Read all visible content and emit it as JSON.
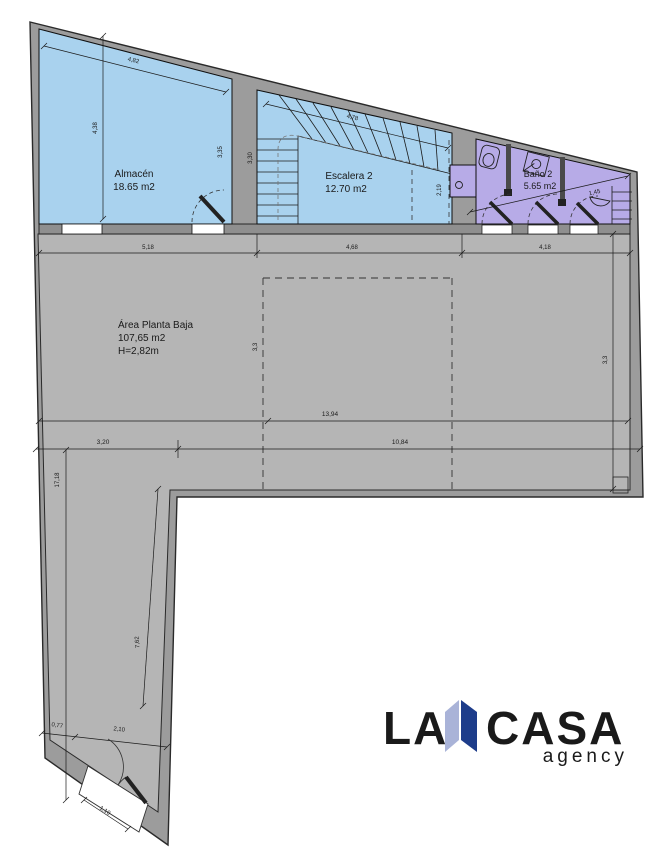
{
  "plan": {
    "rooms": {
      "almacen": {
        "name": "Almacén",
        "area": "18.65 m2"
      },
      "escalera": {
        "name": "Escalera 2",
        "area": "12.70 m2"
      },
      "bano": {
        "name": "Baño 2",
        "area": "5.65 m2"
      },
      "planta": {
        "name": "Área Planta Baja",
        "area": "107,65 m2",
        "height": "H=2,82m"
      }
    },
    "dims": {
      "almacen_top": "4,82",
      "almacen_left": "4,38",
      "almacen_right": "3,35",
      "escalera_top": "4,78",
      "escalera_left": "3,30",
      "escalera_right": "2,19",
      "bano_width": "1,45",
      "row_top": {
        "a": "5,18",
        "b": "4,68",
        "c": "4,18"
      },
      "mid_long": "13,94",
      "mid_left_v": "3,3",
      "mid_right_v": "3,3",
      "bottom_left": "3,20",
      "bottom_right": "10,84",
      "col_height": "17,18",
      "col_diag": "7,62",
      "notch": "0,77",
      "door_run": "2,10",
      "door_width": "1,10"
    },
    "colors": {
      "wall": "#9c9c9c",
      "band": "#8f8f8f",
      "floor": "#b5b5b5",
      "room_blue": "#a9d2ee",
      "room_purple": "#b7abe7"
    }
  },
  "logo": {
    "la": "LA",
    "casa": "CASA",
    "agency": "agency",
    "navy": "#1d3c8a",
    "light": "#a9b3d8",
    "gray": "#9aa1a9"
  }
}
